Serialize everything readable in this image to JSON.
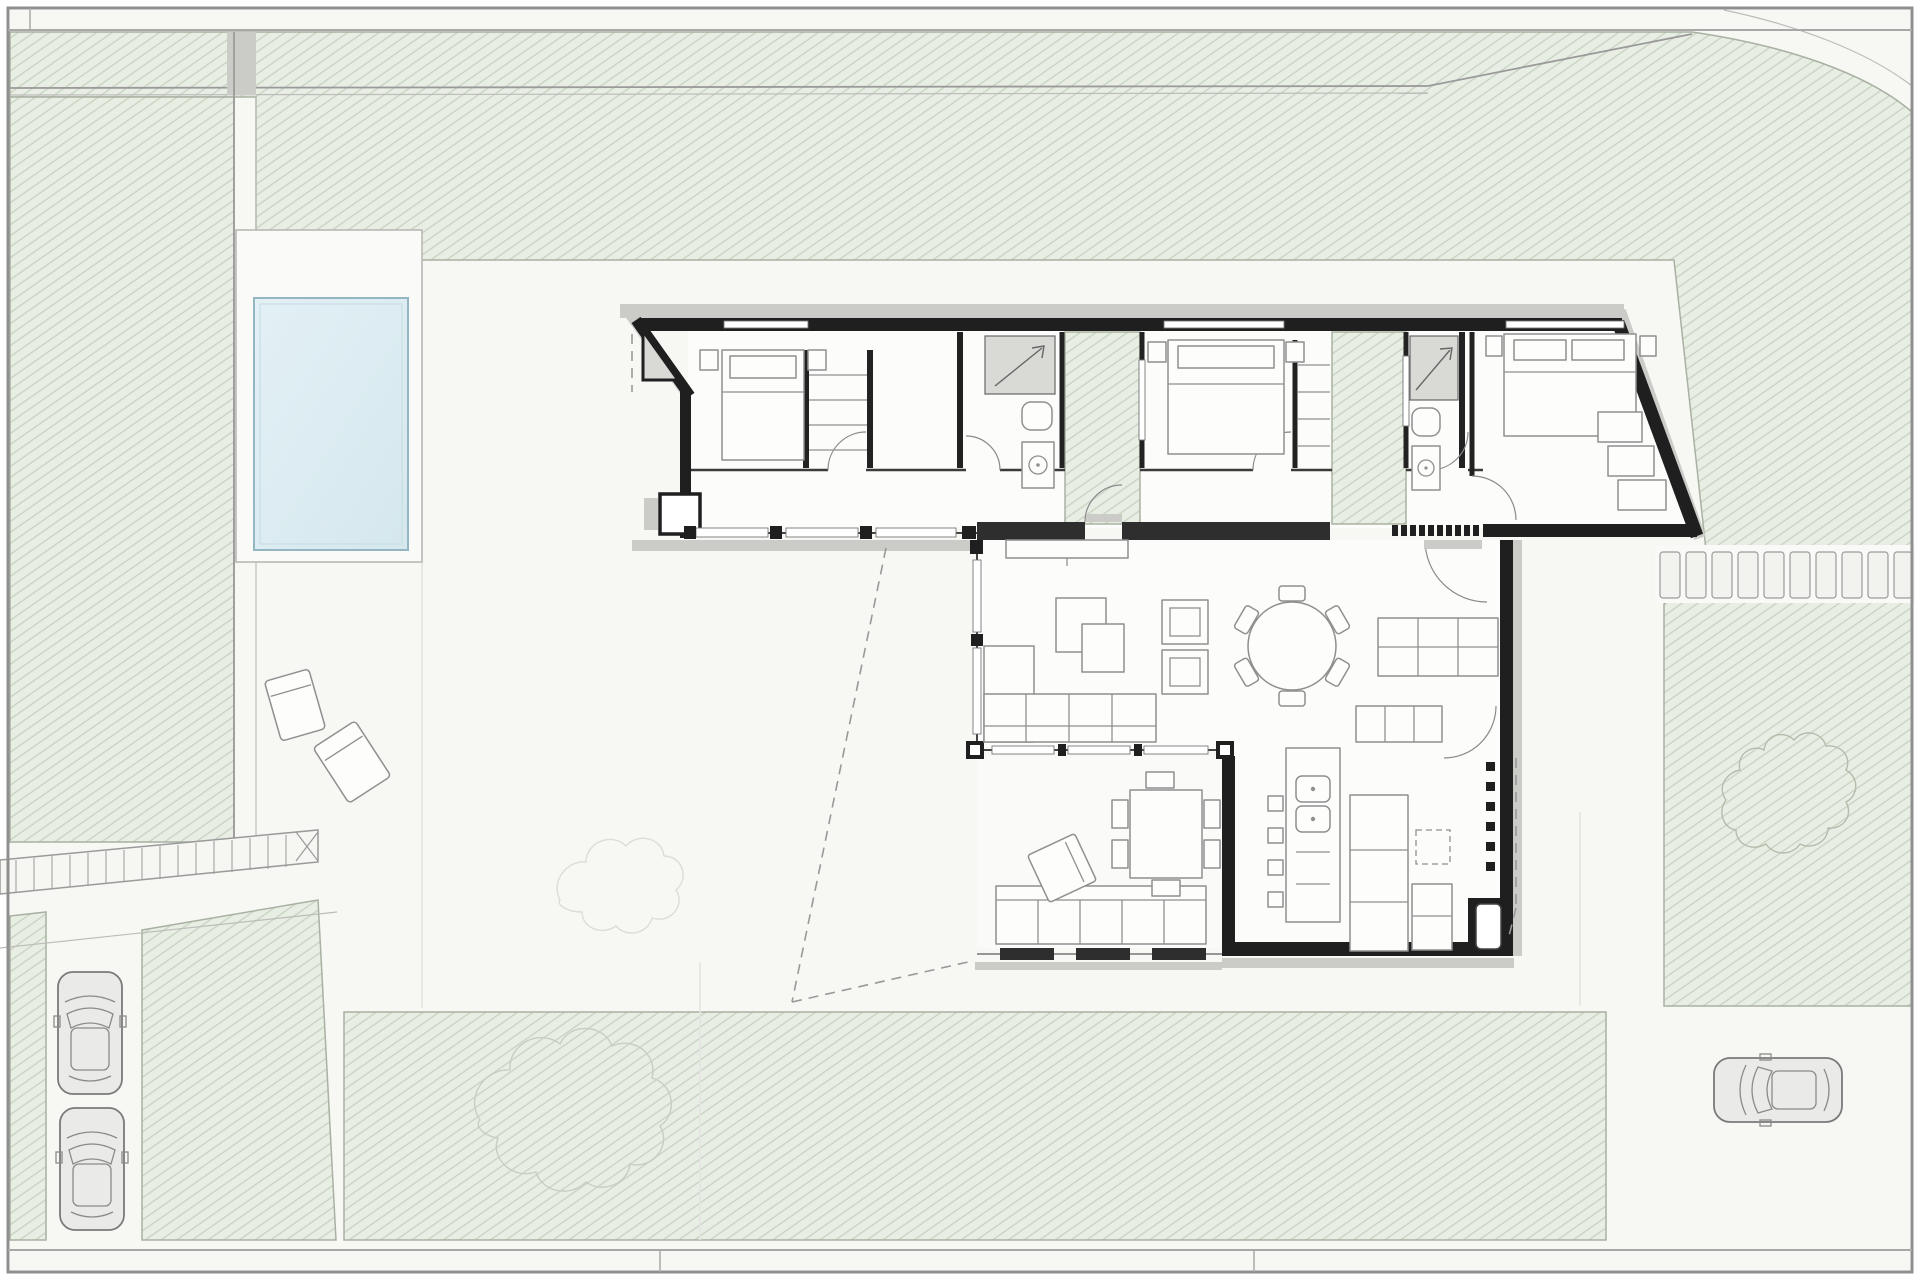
{
  "meta": {
    "title": "Single-storey modern villa — architectural site / floor plan, top view",
    "drawing_type": "floor plan with landscaped plot",
    "scale_text": "",
    "visible_text": "none — drawing contains no labels or dimensions"
  },
  "palette": {
    "yard": "#f7f7f4",
    "lawn-base": "#e9eee4",
    "lawn-hatch": "#c6d2bf",
    "lawn-edge": "#a8b1a2",
    "pool-water": "#e3f0f5",
    "pool-deep": "#d5e8ee",
    "pool-edge": "#93b6c2",
    "wall": "#1f1f1f",
    "wall-dark": "#2e2e2e",
    "furn": "#8f8f8f",
    "gray-light": "#cbcbc8",
    "gray-mid": "#d9d9d5",
    "dashc": "#999999",
    "stone": "#f2f2ef",
    "car": "#eaeae8",
    "shrub": "#b4bcac",
    "frame": "#8f8f8f"
  },
  "site": {
    "label": "Landscaped plot",
    "plot": {
      "label": "Plot with hatched lawns, paved yard and boundary fence"
    },
    "pool": {
      "label": "Swimming pool with surrounding deck"
    },
    "loungers": {
      "label": "Two sun loungers beside pool",
      "count": 2
    },
    "footbridge": {
      "label": "Ramped walkway with treads, lower-left entrance"
    },
    "gate_path": {
      "label": "Side footpath along left lawn"
    },
    "stepping_stones": {
      "label": "Stepping-stone path to right lawn",
      "count": 10
    },
    "driveway": {
      "label": "Driveway parking strip, lower left"
    },
    "cars": {
      "label": "Parked cars",
      "count": 3,
      "positions": [
        "driveway upper",
        "driveway lower",
        "street lower right"
      ]
    },
    "road": {
      "label": "Curved road corner, top right"
    },
    "shrubs": {
      "label": "Organic shrub outlines on right lawn and lower band"
    }
  },
  "house": {
    "label": "Elongated villa with angled end walls",
    "rooms": [
      {
        "id": "entry-porch",
        "label": "Entry porch with triangular canopy and column"
      },
      {
        "id": "bedroom-1",
        "label": "Bedroom 1 — double bed, nightstands, walk-through wardrobe"
      },
      {
        "id": "bathroom-1",
        "label": "Bathroom 1 — shower, WC, washbasin"
      },
      {
        "id": "patio-1",
        "label": "Internal planted patio 1"
      },
      {
        "id": "bedroom-2",
        "label": "Bedroom 2 — double bed, closet wall"
      },
      {
        "id": "patio-2",
        "label": "Internal planted patio 2"
      },
      {
        "id": "bathroom-2",
        "label": "Bathroom 2 — shower, WC, washbasin"
      },
      {
        "id": "master-bedroom",
        "label": "Master bedroom — double bed, wardrobe along angled wall"
      },
      {
        "id": "corridor",
        "label": "Glazed gallery corridor along bedroom wing"
      },
      {
        "id": "living-dining",
        "label": "Living–dining room — L-sofa, armchairs, side tables, round table with 6 chairs, TV bench"
      },
      {
        "id": "kitchen",
        "label": "Kitchen — island with double sink, 4 bar stools, L-counters, pantry shelving"
      },
      {
        "id": "hallway",
        "label": "Hall with entrance door and brise-soleil screen"
      },
      {
        "id": "covered-terrace",
        "label": "Covered terrace — outdoor sofa, ottoman, dining table with 6 chairs"
      }
    ],
    "structure": {
      "glazing": "full-height glazed walls on living volume and corridor south facade",
      "screen": "row of brise-soleil louvers beside entrance and on east service wall",
      "roof": "dashed lines mark roof overhang projection"
    }
  }
}
